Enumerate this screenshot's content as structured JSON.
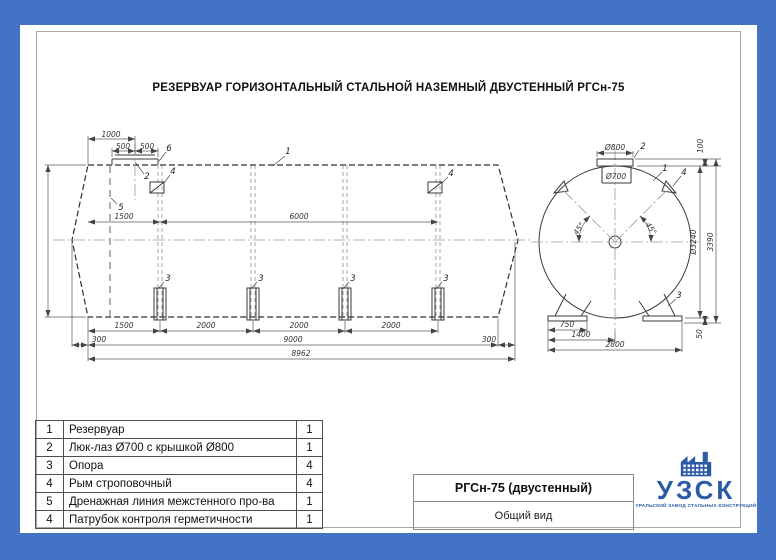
{
  "page": {
    "title": "РЕЗЕРВУАР ГОРИЗОНТАЛЬНЫЙ СТАЛЬНОЙ НАЗЕМНЫЙ ДВУСТЕННЫЙ РГСн-75"
  },
  "side_view": {
    "dims": {
      "top": [
        "1000",
        "500",
        "500"
      ],
      "height": "3240",
      "mid": [
        "1500",
        "6000"
      ],
      "row1": [
        "1500",
        "2000",
        "2000",
        "2000"
      ],
      "row2": [
        "300",
        "9000",
        "300"
      ],
      "row3": [
        "8962"
      ]
    },
    "callouts": {
      "tank": "1",
      "manhole": "2",
      "support": "3",
      "lug": "4",
      "drain": "5",
      "fitting": "6"
    }
  },
  "end_view": {
    "dims": {
      "flange_d": "Ø800",
      "neck_d": "Ø700",
      "flange_h": "100",
      "shell_d": "Ø3240",
      "total_h": "3390",
      "base_h": "50",
      "base_750": "750",
      "base_1400": "1400",
      "base_2800": "2800",
      "angle": "45°"
    },
    "callouts": {
      "shell": "1",
      "manhole": "2",
      "support": "3",
      "lug": "4"
    }
  },
  "parts_table": {
    "rows": [
      {
        "num": "1",
        "name": "Резервуар",
        "qty": "1"
      },
      {
        "num": "2",
        "name": "Люк-лаз Ø700 с крышкой Ø800",
        "qty": "1"
      },
      {
        "num": "3",
        "name": "Опора",
        "qty": "4"
      },
      {
        "num": "4",
        "name": "Рым строповочный",
        "qty": "4"
      },
      {
        "num": "5",
        "name": "Дренажная линия межстенного про-ва",
        "qty": "1"
      },
      {
        "num": "4",
        "name": "Патрубок контроля герметичности",
        "qty": "1"
      }
    ]
  },
  "title_block": {
    "model": "РГСн-75 (двустенный)",
    "view_name": "Общий вид"
  },
  "logo": {
    "abbr": "УЗСК",
    "tagline": "УРАЛЬСКИЙ ЗАВОД СТАЛЬНЫХ КОНСТРУКЦИЙ"
  },
  "colors": {
    "background": "#4472c4",
    "logo_blue": "#2b5aa7",
    "line": "#333333"
  }
}
